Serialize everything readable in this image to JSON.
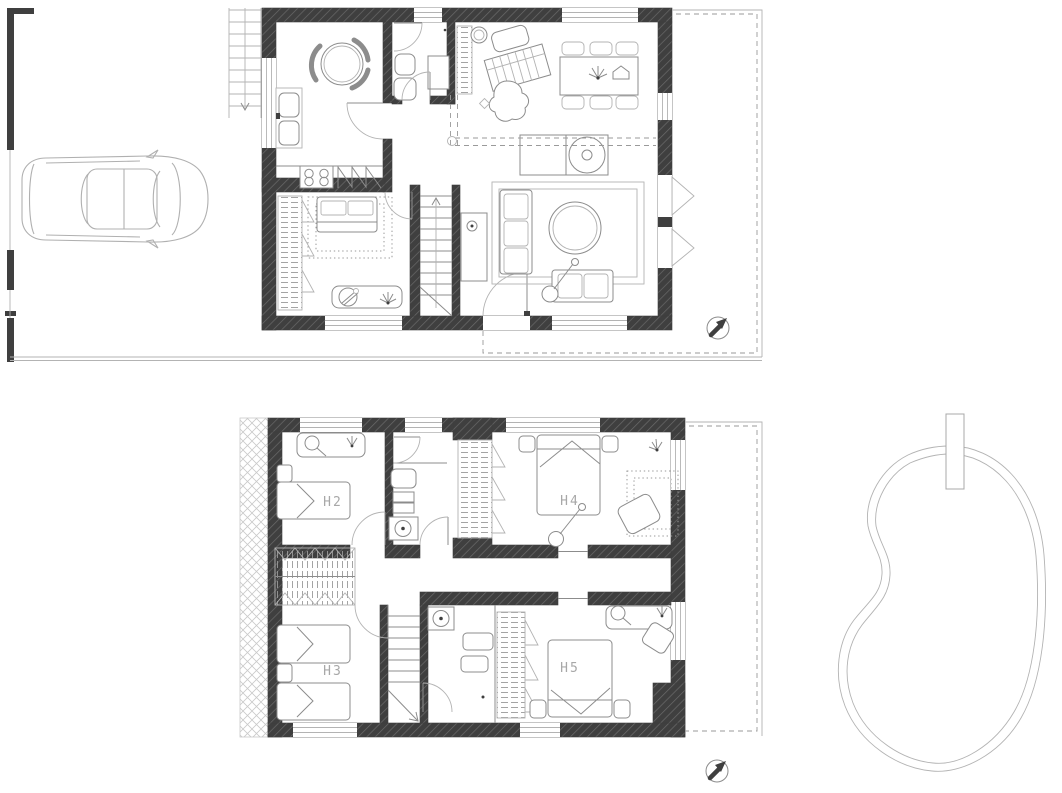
{
  "plan": {
    "type": "architectural floor plan, two storeys with site",
    "upper_floor_rooms": [
      {
        "id": "h2",
        "label": "H2"
      },
      {
        "id": "h3",
        "label": "H3"
      },
      {
        "id": "h4",
        "label": "H4"
      },
      {
        "id": "h5",
        "label": "H5"
      }
    ]
  },
  "symbols": {
    "north_arrow": "north-arrow-compass",
    "car": "car-top-view",
    "pool": "kidney-shaped-pool",
    "pool_board": "diving-board",
    "exterior_stairs": "entry-steps-with-arrow",
    "interior_stairs": "staircase-with-break-line",
    "wardrobes": "wardrobe-with-hangers",
    "doors": "door-swing-arc",
    "terrace_boundary": "dashed-terrace-outline"
  },
  "colors": {
    "background": "#ffffff",
    "wall_fill": "#3f3f3f",
    "wall_hatch_line": "#6a6a6a",
    "drawing_line": "#8c8c8c",
    "light_line": "#b3b3b3",
    "label_text": "#a8a8a8"
  }
}
